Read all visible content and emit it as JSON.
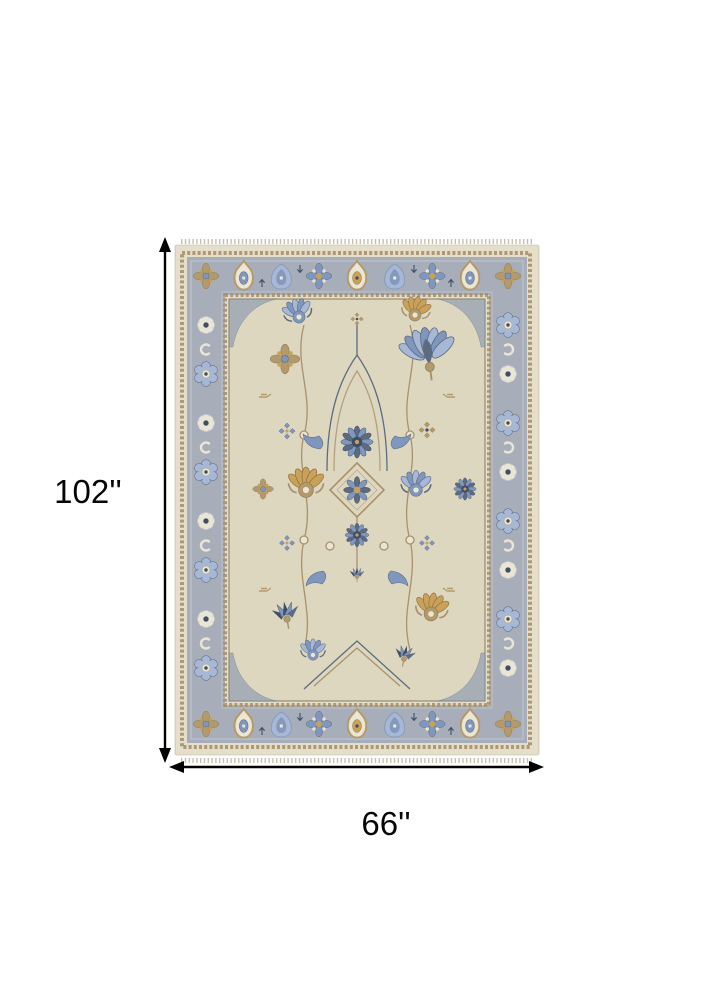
{
  "image": {
    "width": 713,
    "height": 1000,
    "background": "#ffffff"
  },
  "annotations": {
    "height_label": "102''",
    "width_label": "66''",
    "arrow_color": "#000000",
    "label_color": "#060606"
  },
  "rug": {
    "description": "Beige and blue-gray Oushak style area rug with floral trellis field and palmette border",
    "palette": {
      "outerCream": "#e5decb",
      "guardTan": "#a8916b",
      "borderGray": "#a7aeb9",
      "borderLight": "#c9ced6",
      "fieldCream": "#ded7c0",
      "brownLine": "#8b7a58",
      "blue": "#7f96bd",
      "lightBlue": "#a6b8d6",
      "slate": "#5d6b80",
      "navy": "#3f4d66",
      "tan": "#b49a6b",
      "gold": "#c9a158",
      "cream": "#ebe5d3",
      "white": "#f4f1e8",
      "fringeC": "#c6bfae",
      "bg": "#ffffff"
    }
  }
}
